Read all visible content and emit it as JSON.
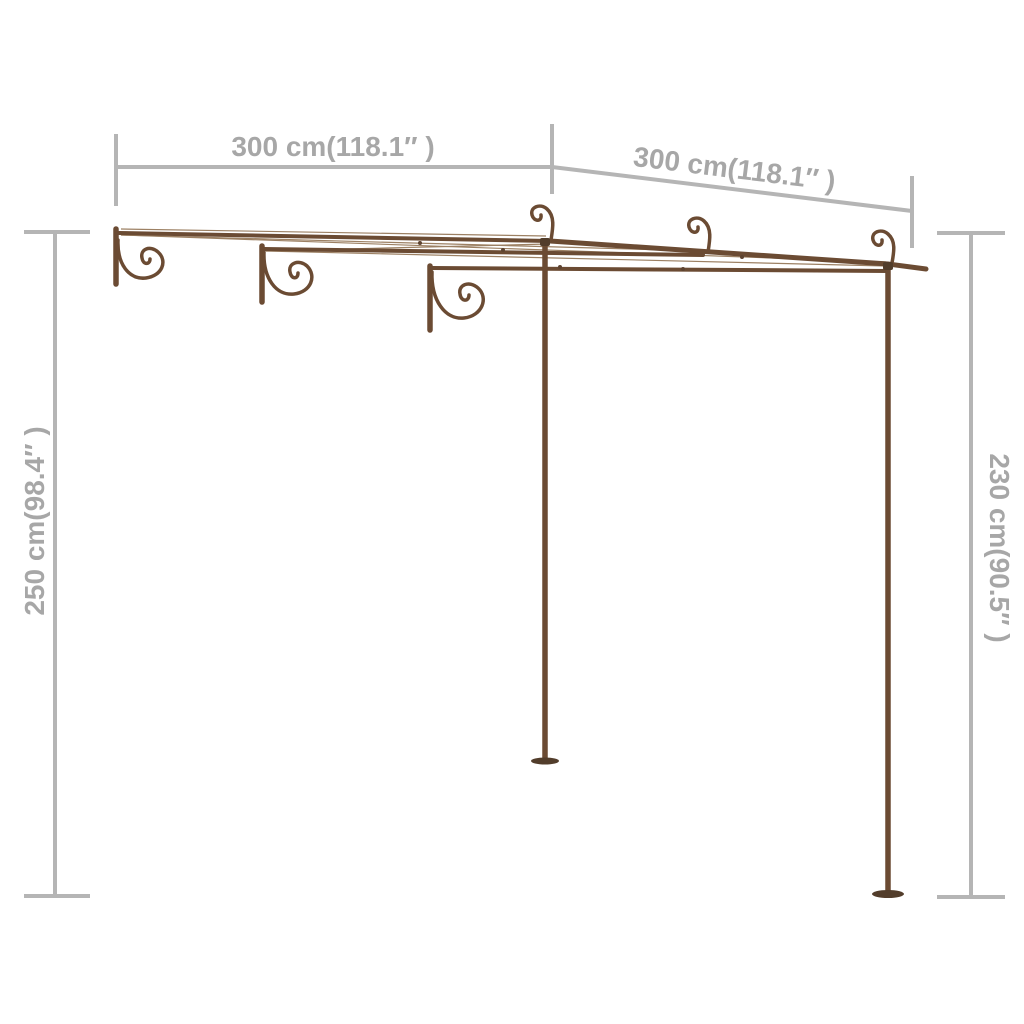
{
  "canvas": {
    "background": "#ffffff"
  },
  "colors": {
    "dimension_line": "#b5b5b5",
    "dimension_text": "#a7a7a7",
    "metal": "#6b4b33",
    "metal_dark": "#523d2b",
    "wire": "#9c8063"
  },
  "dimensions": {
    "top_left": {
      "label": "300 cm(118.1″ )"
    },
    "top_right": {
      "label": "300 cm(118.1″ )"
    },
    "left": {
      "label": "250 cm(98.4″ )"
    },
    "right": {
      "label": "230 cm(90.5″ )"
    }
  }
}
